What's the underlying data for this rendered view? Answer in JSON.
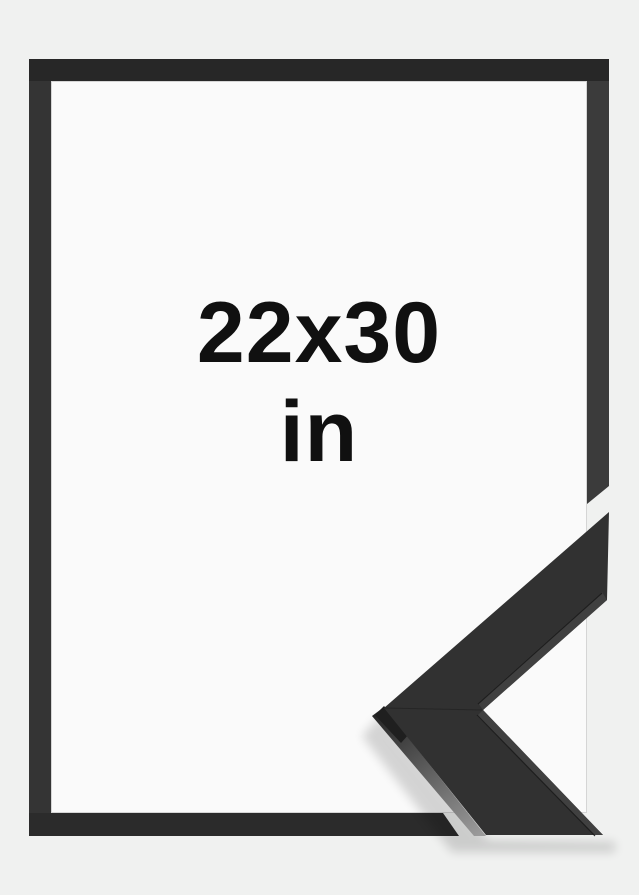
{
  "product_image": {
    "size_label": "22x30",
    "unit_label": "in"
  },
  "colors": {
    "background": "#f0f1f0",
    "interior": "#fafafa",
    "frame_top": "#272727",
    "frame_left": "#343434",
    "frame_right": "#3b3b3b",
    "frame_bottom": "#2b2b2b",
    "inner_lip": "#c8c8c8",
    "detail_face": "#313131",
    "detail_edge": "#404040",
    "detail_seam": "#1b1b1b",
    "detail_dark_edge": "#1f1f1f",
    "detail_side_start": "#262626",
    "detail_side_end": "#9b9b9b",
    "text": "#101010"
  }
}
